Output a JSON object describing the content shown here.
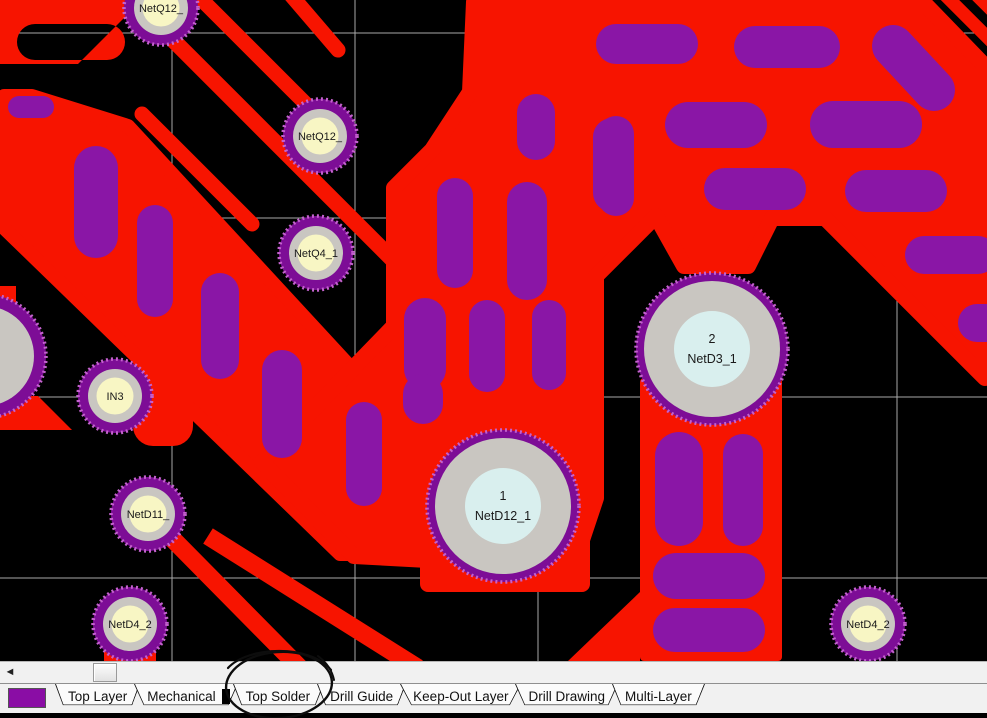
{
  "canvas": {
    "background": "#000000",
    "grid_color": "#a9a9a9",
    "copper_color": "#f71400",
    "pill_color": "#8a16a6",
    "pad_ring_purple": "#7d0d96",
    "pad_ring_speckle": "#c462ce",
    "pad_ring_gray": "#c9c6c1",
    "pad_inner_small": "#f8f6c4",
    "pad_inner_large": "#d9efee",
    "pad_text_color": "#1a1a1a",
    "pads": [
      {
        "label": "NetQ12_",
        "x": 161,
        "y": 8,
        "size": "small"
      },
      {
        "label": "NetQ12_",
        "x": 320,
        "y": 136,
        "size": "small"
      },
      {
        "label": "NetQ4_1",
        "x": 316,
        "y": 253,
        "size": "small"
      },
      {
        "label": "IN3",
        "x": 115,
        "y": 396,
        "size": "small"
      },
      {
        "label": "NetD11_",
        "x": 148,
        "y": 514,
        "size": "small"
      },
      {
        "label": "NetD4_2",
        "x": 130,
        "y": 624,
        "size": "small"
      },
      {
        "label": "NetD4_2",
        "x": 868,
        "y": 624,
        "size": "small"
      },
      {
        "number": "1",
        "label": "NetD12_1",
        "x": 503,
        "y": 506,
        "size": "large"
      },
      {
        "number": "2",
        "label": "NetD3_1",
        "x": 712,
        "y": 349,
        "size": "large"
      },
      {
        "x": -16,
        "y": 356,
        "size": "edge"
      }
    ]
  },
  "scrollbar": {
    "left_arrow": "◄"
  },
  "tabs": {
    "swatch_color": "#8a0da5",
    "items": [
      {
        "label": "Top Layer"
      },
      {
        "label": "Mechanical",
        "trailing_bar": true
      },
      {
        "label": "Top Solder"
      },
      {
        "label": "Drill Guide"
      },
      {
        "label": "Keep-Out Layer"
      },
      {
        "label": "Drill Drawing"
      },
      {
        "label": "Multi-Layer"
      }
    ]
  },
  "annotation": {
    "shape": "hand-drawn-circle",
    "target": "Top Solder"
  }
}
